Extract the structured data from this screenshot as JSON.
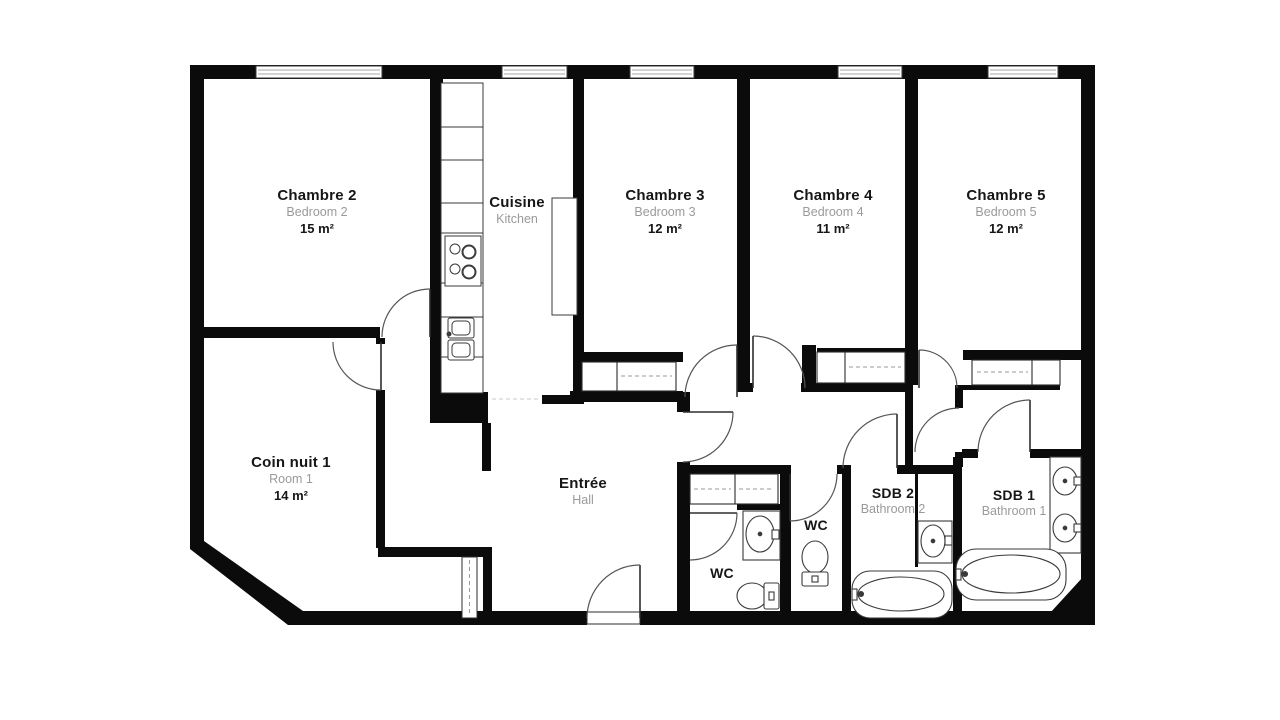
{
  "plan": {
    "colors": {
      "wall": "#0b0b0b",
      "text": "#161616",
      "muted": "#9a9a9a",
      "fixture_line": "#333333"
    },
    "rooms": [
      {
        "id": "chambre2",
        "title": "Chambre 2",
        "subtitle": "Bedroom 2",
        "area": "15 m²"
      },
      {
        "id": "cuisine",
        "title": "Cuisine",
        "subtitle": "Kitchen",
        "area": ""
      },
      {
        "id": "chambre3",
        "title": "Chambre 3",
        "subtitle": "Bedroom 3",
        "area": "12 m²"
      },
      {
        "id": "chambre4",
        "title": "Chambre 4",
        "subtitle": "Bedroom 4",
        "area": "11 m²"
      },
      {
        "id": "chambre5",
        "title": "Chambre 5",
        "subtitle": "Bedroom 5",
        "area": "12 m²"
      },
      {
        "id": "coin_nuit",
        "title": "Coin nuit 1",
        "subtitle": "Room 1",
        "area": "14 m²"
      },
      {
        "id": "entree",
        "title": "Entrée",
        "subtitle": "Hall",
        "area": ""
      },
      {
        "id": "wc_hall",
        "title": "WC",
        "subtitle": "",
        "area": ""
      },
      {
        "id": "wc_small",
        "title": "WC",
        "subtitle": "",
        "area": ""
      },
      {
        "id": "sdb2",
        "title": "SDB 2",
        "subtitle": "Bathroom 2",
        "area": ""
      },
      {
        "id": "sdb1",
        "title": "SDB 1",
        "subtitle": "Bathroom 1",
        "area": ""
      }
    ]
  }
}
